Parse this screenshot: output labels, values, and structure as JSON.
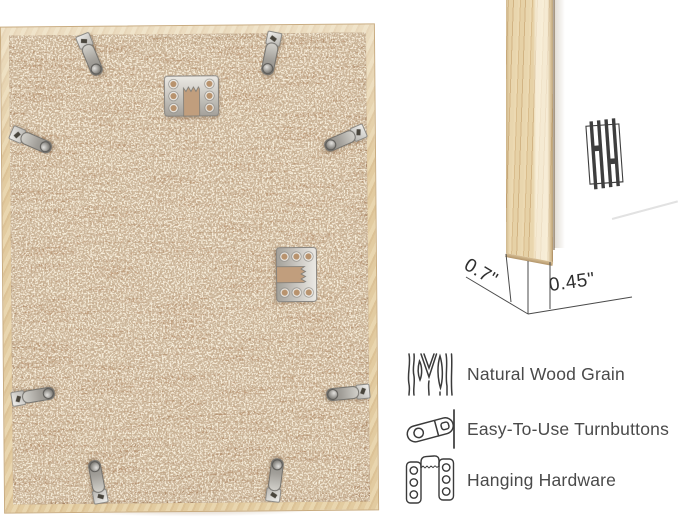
{
  "detail_view": {
    "depth_label": "0.7\"",
    "face_label": "0.45\""
  },
  "features": {
    "items": [
      {
        "icon": "wood-grain-icon",
        "label": "Natural Wood Grain"
      },
      {
        "icon": "turnbutton-icon",
        "label": "Easy-To-Use Turnbuttons"
      },
      {
        "icon": "hanging-hardware-icon",
        "label": "Hanging Hardware"
      }
    ]
  },
  "back_view": {
    "turnbutton_count": 8,
    "hanger_count": 2
  },
  "colors": {
    "background": "#ffffff",
    "frame_wood": "#e3cda4",
    "board_tan": "#c6a384",
    "metal": "#c9c6c0",
    "text": "#4a4a4a",
    "annotation_line": "#4a4a4a",
    "logo": "#3e3e3e"
  }
}
